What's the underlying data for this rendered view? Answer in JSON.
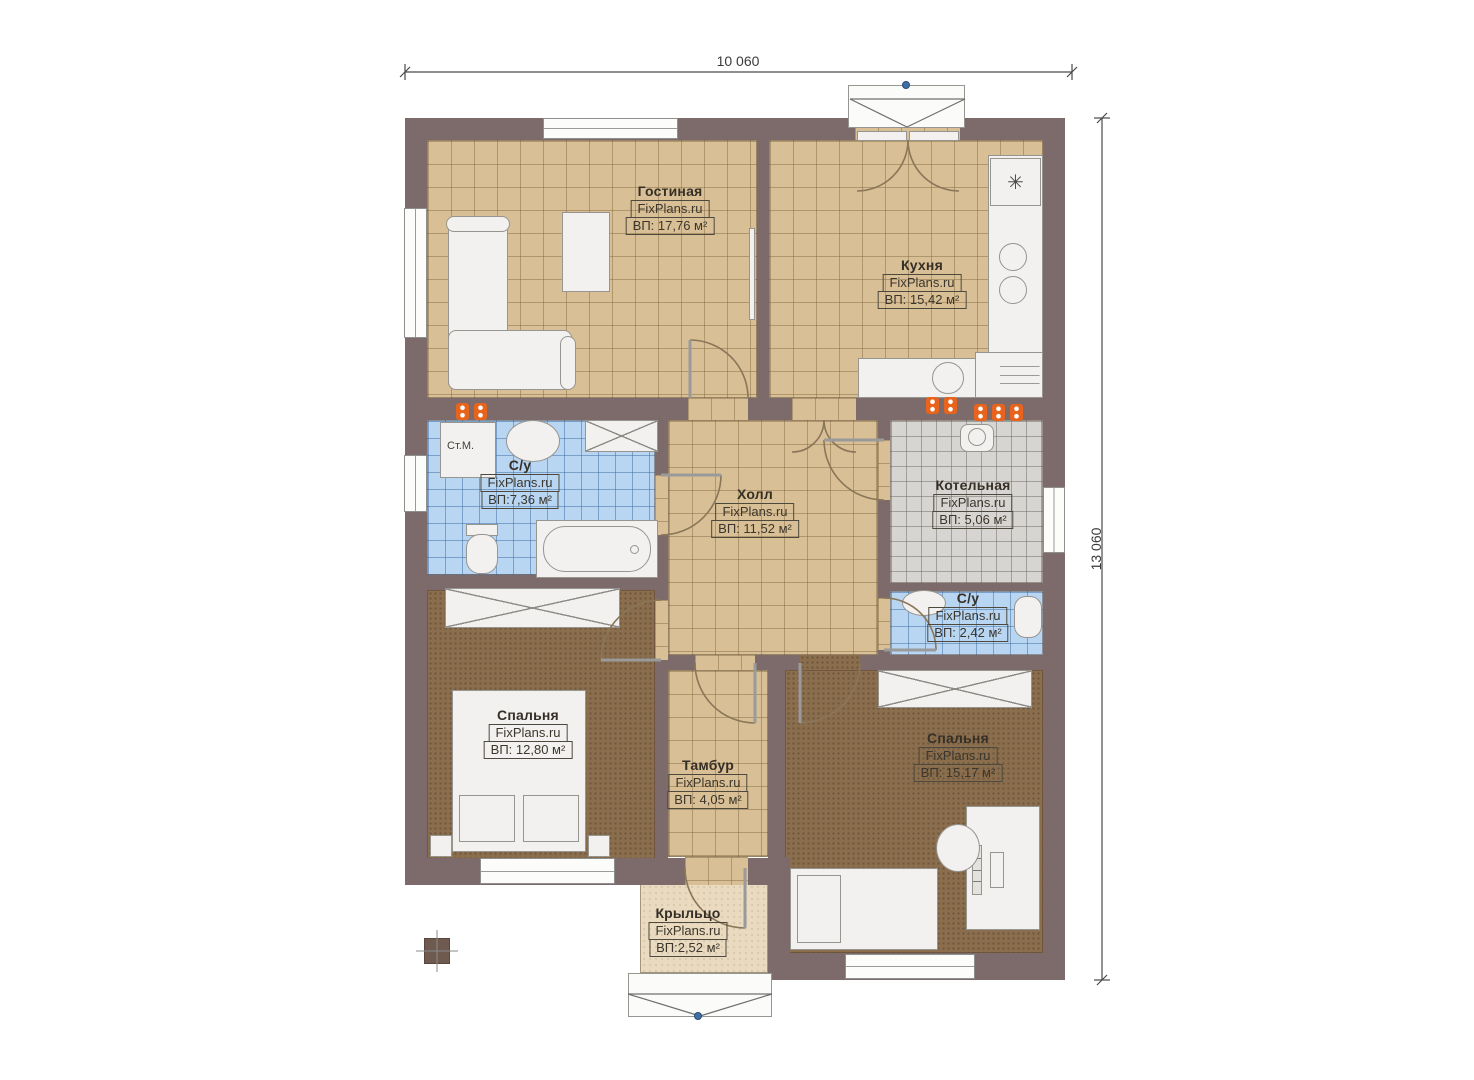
{
  "title": "Floor plan",
  "dimensions": {
    "width_label": "10 060",
    "height_label": "13 060"
  },
  "rooms": [
    {
      "name": "Гостиная",
      "brand": "FixPlans.ru",
      "area": "ВП: 17,76 м²"
    },
    {
      "name": "Кухня",
      "brand": "FixPlans.ru",
      "area": "ВП: 15,42 м²"
    },
    {
      "name": "С/у",
      "brand": "FixPlans.ru",
      "area": "ВП:7,36 м²"
    },
    {
      "name": "Холл",
      "brand": "FixPlans.ru",
      "area": "ВП: 11,52 м²"
    },
    {
      "name": "Котельная",
      "brand": "FixPlans.ru",
      "area": "ВП: 5,06 м²"
    },
    {
      "name": "С/у",
      "brand": "FixPlans.ru",
      "area": "ВП: 2,42 м²"
    },
    {
      "name": "Спальня",
      "brand": "FixPlans.ru",
      "area": "ВП: 12,80 м²"
    },
    {
      "name": "Тамбур",
      "brand": "FixPlans.ru",
      "area": "ВП: 4,05 м²"
    },
    {
      "name": "Спальня",
      "brand": "FixPlans.ru",
      "area": "ВП: 15,17 м²"
    },
    {
      "name": "Крыльцо",
      "brand": "FixPlans.ru",
      "area": "ВП:2,52 м²"
    }
  ],
  "labels": {
    "washing_machine": "Ст.М."
  },
  "icons": {
    "vent_symbol": "✳"
  },
  "colors": {
    "wall": "#7d6b6b",
    "floor_tan": "#d8bf95",
    "floor_blue": "#b8d6f2",
    "floor_gray": "#d7d5d2",
    "floor_brown": "#8a6e4d",
    "floor_porch": "#e9dac0",
    "radiator": "#e8641c",
    "marker": "#3f6fa8"
  }
}
